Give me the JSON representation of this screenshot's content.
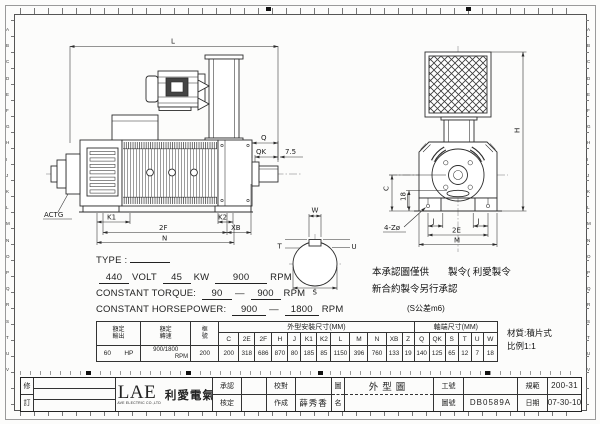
{
  "frame": {
    "ruler_letters": "ABCDEFGHIJKLMNOPQRSTUV"
  },
  "labels": {
    "L": "L",
    "Q": "Q",
    "QK": "QK",
    "seven_five": "7.5",
    "actg": "ACTG",
    "K1": "K1",
    "K2": "K2",
    "F2": "2F",
    "XB": "XB",
    "N": "N",
    "W": "W",
    "T": "T",
    "U": "U",
    "S": "S",
    "H": "H",
    "C": "C",
    "d18": "18",
    "holes": "4-Zø",
    "J": "J",
    "E2": "2E",
    "M": "M"
  },
  "specs": {
    "type_label": "TYPE :",
    "type_value": "",
    "volt_value": "440",
    "volt_label": "VOLT",
    "kw_value": "45",
    "kw_label": "KW",
    "rpm_value": "900",
    "rpm_label": "RPM",
    "ct_label": "CONSTANT TORQUE:",
    "ct_from": "90",
    "dash": "—",
    "ct_to": "900",
    "ct_unit": "RPM",
    "chp_label": "CONSTANT HORSEPOWER:",
    "chp_from": "900",
    "chp_to": "1800",
    "chp_unit": "RPM"
  },
  "notes": {
    "approval_line1": "本承認圖僅供　　製令( 利愛製令",
    "approval_line2": "新合約製令另行承認",
    "tolerance": "(S公差m6)",
    "material": "材質:積片式",
    "scale": "比例1:1"
  },
  "table": {
    "rated_output_label": "額定\n輸出",
    "rated_speed_label": "額定\n轉速",
    "frame_label": "框\n號",
    "dims_group_label": "外型安裝尺寸(MM)",
    "shaft_group_label": "軸端尺寸(MM)",
    "rated_output_value": "60",
    "rated_output_unit": "HP",
    "rated_speed_value": "900/1800",
    "rated_speed_unit": "RPM",
    "frame_value": "200",
    "dim_headers": [
      "C",
      "2E",
      "2F",
      "H",
      "J",
      "K1",
      "K2",
      "L",
      "M",
      "N",
      "XB",
      "Z",
      "Q",
      "QK",
      "S",
      "T",
      "U",
      "W"
    ],
    "dim_values": [
      "200",
      "318",
      "686",
      "870",
      "80",
      "185",
      "85",
      "1150",
      "396",
      "760",
      "133",
      "19",
      "140",
      "125",
      "65",
      "12",
      "7",
      "18"
    ]
  },
  "titleblock": {
    "rev_top": "修",
    "rev_bottom": "訂",
    "logo_lae": "LAE",
    "logo_cn": "利愛電氣",
    "logo_en": "LI AVE ELECTRIC CO.,LTD",
    "approve_label": "承認",
    "check_label": "核定",
    "proof_label": "校對",
    "made_label": "作成",
    "made_value": "薛秀香",
    "name_top": "圖",
    "name_bottom": "名",
    "drawing_name": "外型圖",
    "work_label": "工號",
    "work_value": "",
    "dwg_label": "圖號",
    "dwg_value": "DB0589A",
    "spec_label": "規範",
    "spec_value": "200-31",
    "date_label": "日期",
    "date_value": "07-30-10"
  }
}
